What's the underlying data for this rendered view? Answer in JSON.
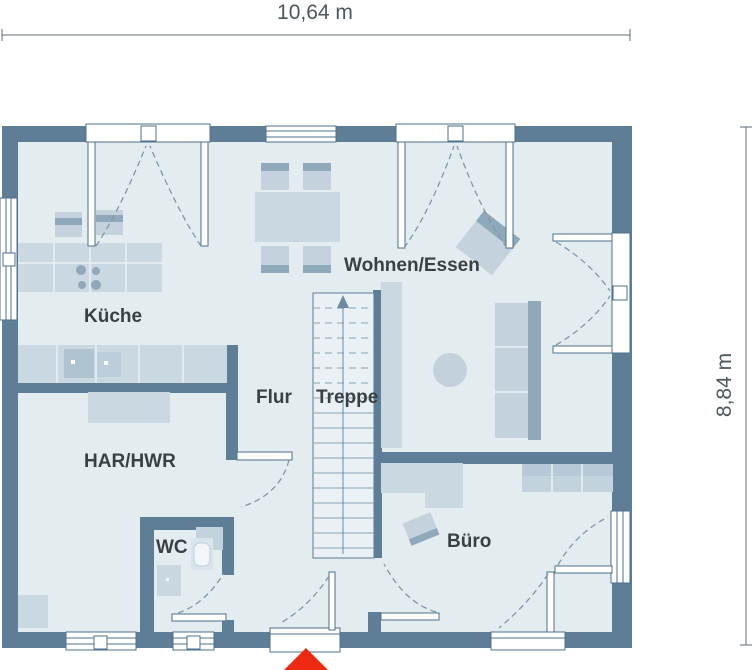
{
  "plan": {
    "type": "floor-plan",
    "dimensions": {
      "width": "10,64 m",
      "height": "8,84 m"
    },
    "rooms": [
      {
        "id": "kueche",
        "label": "Küche"
      },
      {
        "id": "wohnen-essen",
        "label": "Wohnen/Essen"
      },
      {
        "id": "flur",
        "label": "Flur"
      },
      {
        "id": "treppe",
        "label": "Treppe"
      },
      {
        "id": "har-hwr",
        "label": "HAR/HWR"
      },
      {
        "id": "wc",
        "label": "WC"
      },
      {
        "id": "buero",
        "label": "Büro"
      }
    ],
    "markers": {
      "entrance": "entrance-triangle"
    },
    "colors": {
      "wall": "#5e7e98",
      "floor": "#e3edf0",
      "furniture": "#cad8e2",
      "furniture_dark": "#8fa9bb",
      "accent": "#c3d3de",
      "entrance_marker": "#ee2b12",
      "line": "#7d98ad",
      "text": "#3a4145",
      "dim_text": "#4d585e"
    }
  }
}
